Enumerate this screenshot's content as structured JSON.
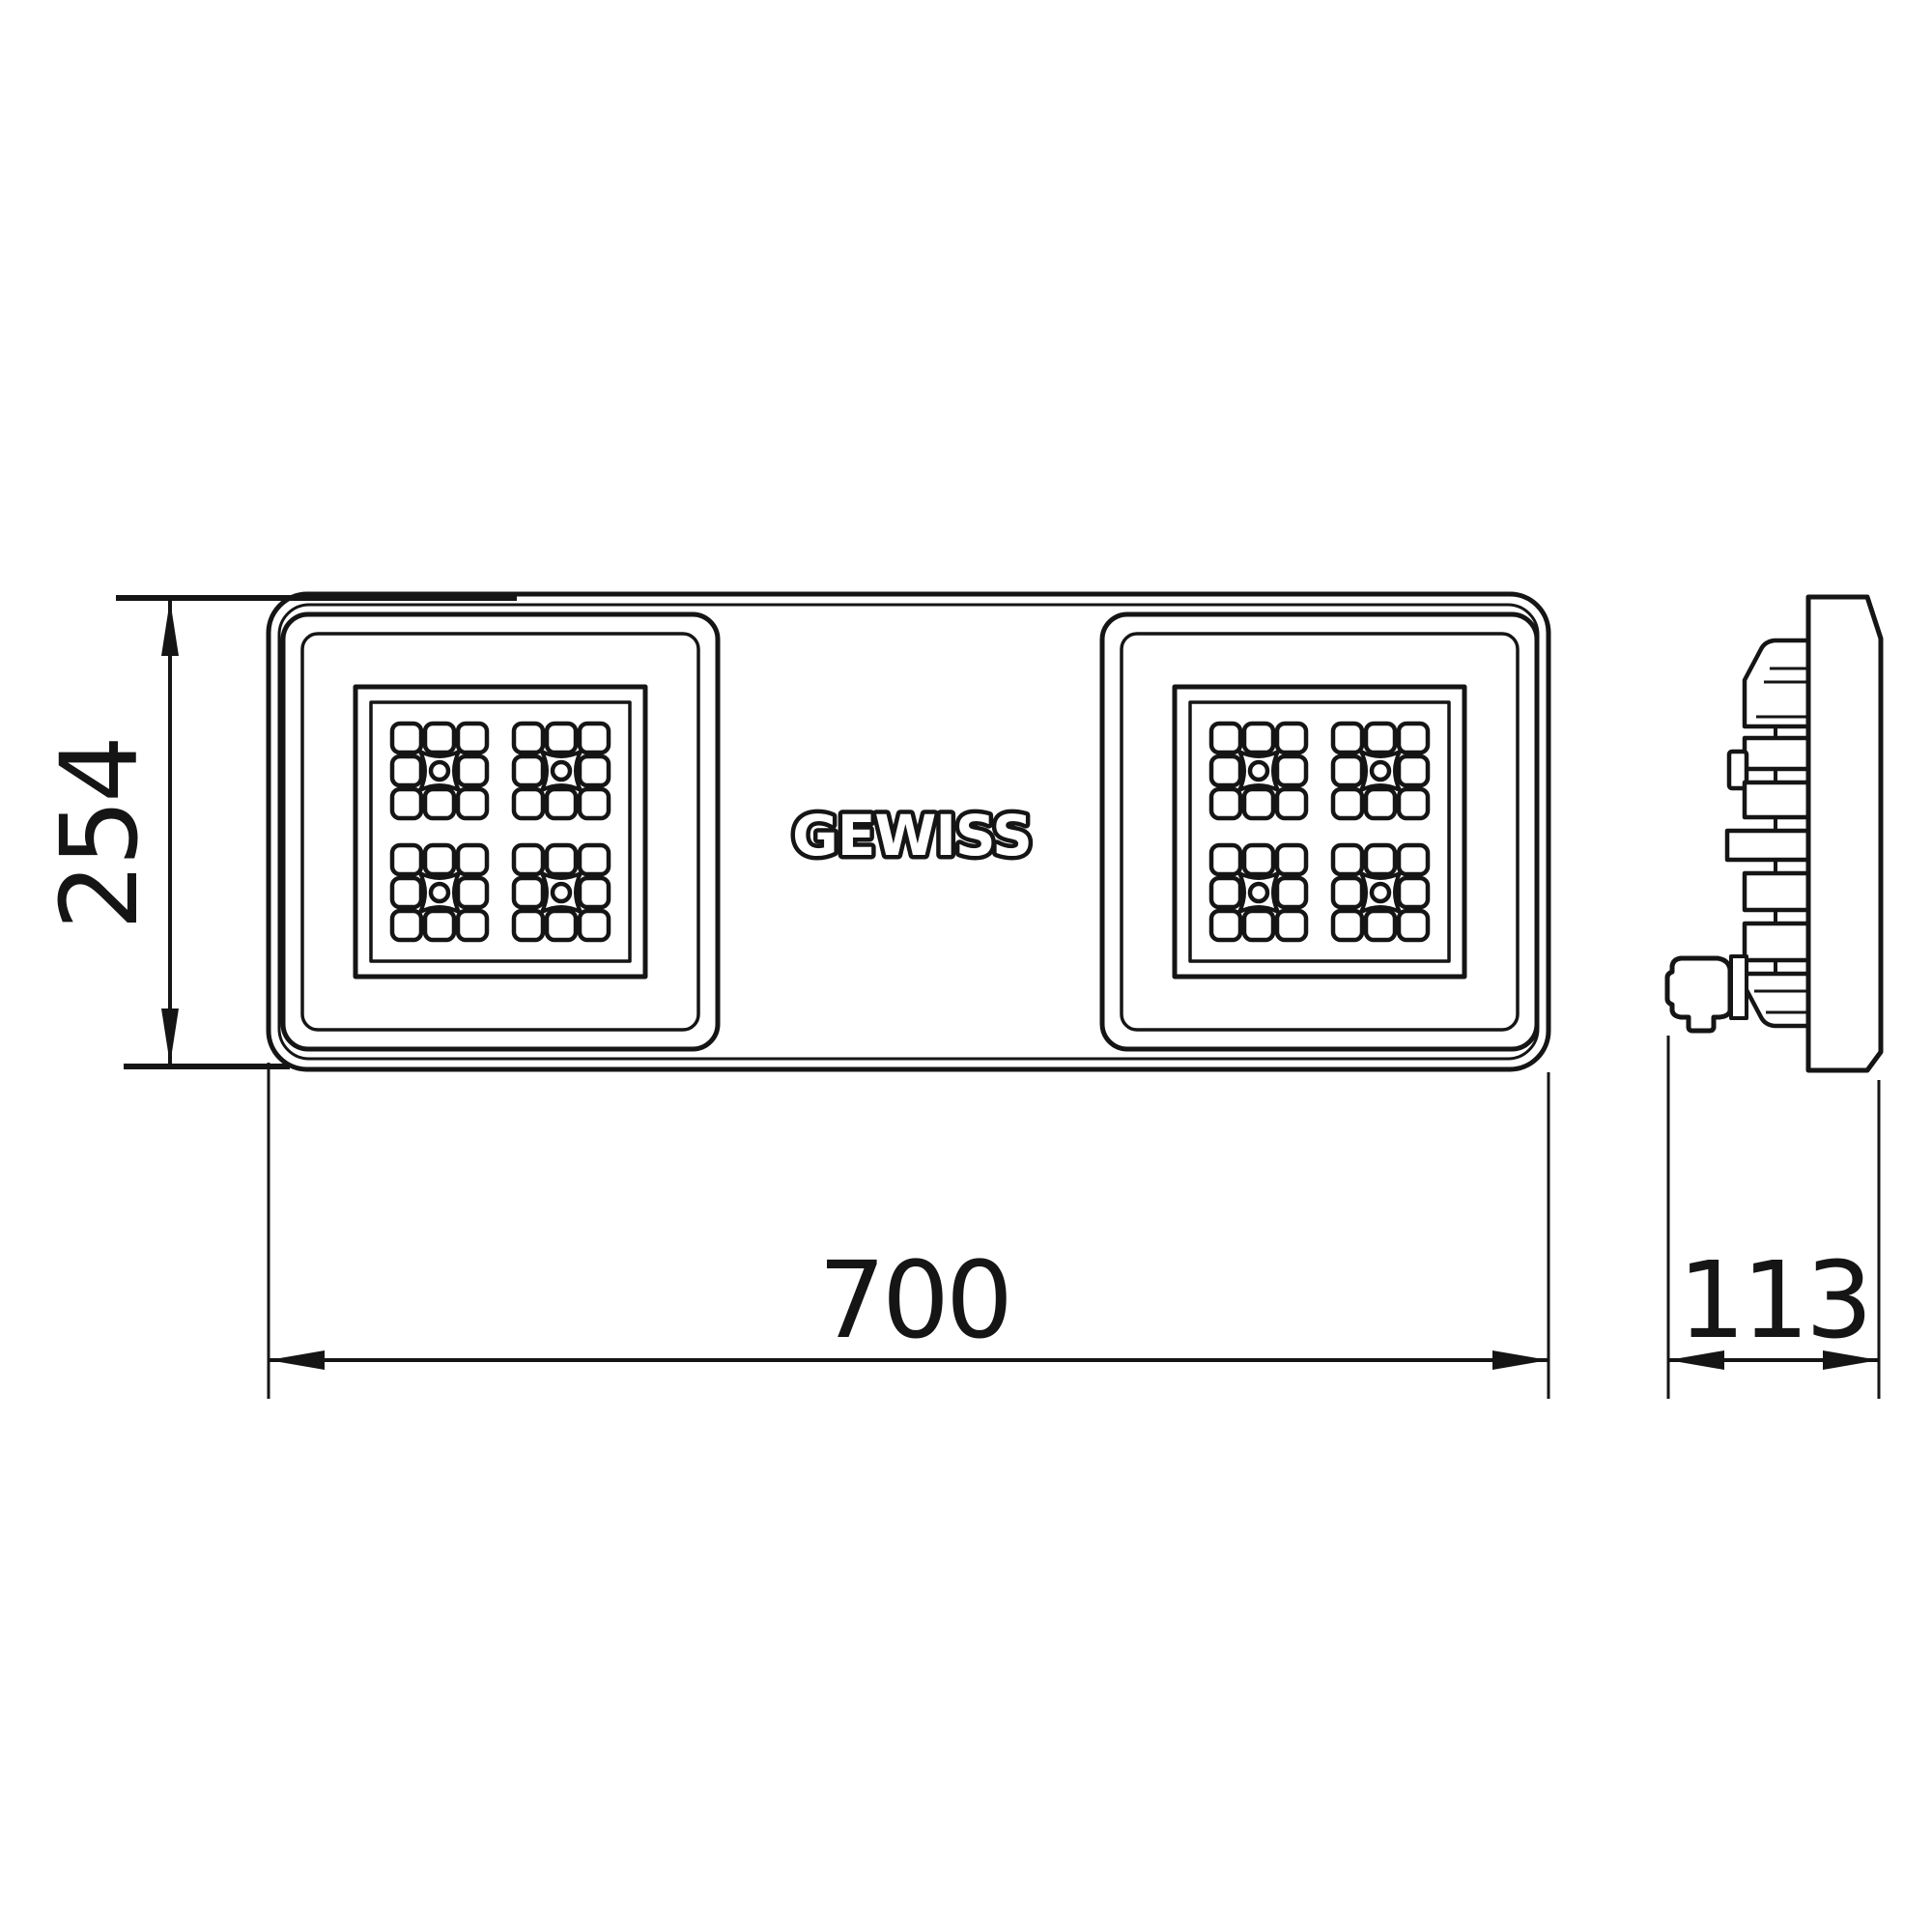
{
  "drawing": {
    "title": "GEWISS LED floodlight dimensional drawing",
    "style": "black line art on white background",
    "line_color": "#151515",
    "background_color": "#ffffff"
  },
  "brand": {
    "logo_text": "GEWISS"
  },
  "views": {
    "front": {
      "name": "front-view",
      "description": "rounded rectangle housing with two square LED modules, each containing 4 LED grids of 3x3 cells with X-diffuser centers",
      "led_module_count": 2,
      "led_grids_per_module": 4
    },
    "side": {
      "name": "side-profile-view",
      "description": "flat front slab with stepped heatsink fins and cable gland at bottom rear"
    }
  },
  "dimensions": {
    "unit": "mm",
    "height": {
      "value": "254",
      "orientation": "vertical",
      "applies_to": "front view height"
    },
    "width": {
      "value": "700",
      "orientation": "horizontal",
      "applies_to": "front view width"
    },
    "depth": {
      "value": "113",
      "orientation": "horizontal",
      "applies_to": "side view depth"
    }
  }
}
